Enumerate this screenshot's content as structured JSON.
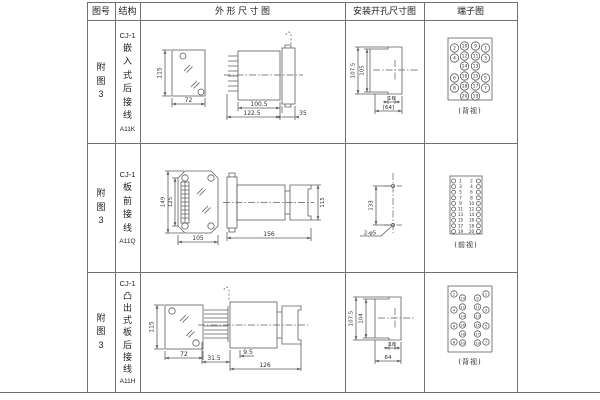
{
  "header": {
    "fig": "图号",
    "structure": "结构",
    "outline": "外 形 尺 寸 图",
    "install": "安装开孔尺寸图",
    "terminal": "端子图"
  },
  "rows": [
    {
      "fig": "附图3",
      "structure": {
        "model": "CJ-1",
        "mount": "嵌入式后接线",
        "code": "A11K"
      },
      "outline": {
        "front_h": "115",
        "front_w": "72",
        "side_d1": "100.5",
        "side_d2": "122.5",
        "side_d3": "35"
      },
      "install": {
        "v_outer": "107.5",
        "v_inner": "105",
        "h_small": "16",
        "h_bracket": "[64]"
      },
      "terminal": {
        "view": "(背视)",
        "grid": [
          [
            "2",
            "10",
            "9",
            "1"
          ],
          [
            "4",
            "12",
            "11",
            "3"
          ],
          [
            "14",
            "13"
          ],
          [
            "6",
            "16",
            "15",
            "5"
          ],
          [
            "8",
            "18",
            "17",
            "7"
          ],
          [
            "20",
            "19"
          ]
        ]
      }
    },
    {
      "fig": "附图3",
      "structure": {
        "model": "CJ-1",
        "mount": "板前接线",
        "code": "A11Q"
      },
      "outline": {
        "front_h1": "149",
        "front_h2": "125",
        "front_w": "105",
        "side_len": "156",
        "side_h": "115"
      },
      "install": {
        "v": "133",
        "holes": "2-φ5"
      },
      "terminal": {
        "view": "(前视)",
        "left": [
          "1",
          "3",
          "5",
          "7",
          "9",
          "11",
          "13",
          "15",
          "17",
          "19"
        ],
        "right": [
          "2",
          "4",
          "6",
          "8",
          "10",
          "12",
          "14",
          "16",
          "18",
          "20"
        ]
      }
    },
    {
      "fig": "附图3",
      "structure": {
        "model": "CJ-1",
        "mount": "凸出式板后接线",
        "code": "A11H"
      },
      "outline": {
        "front_h": "115",
        "front_w": "72",
        "side_d1": "31.5",
        "side_d2": "9.5",
        "side_d3": "126"
      },
      "install": {
        "v_outer": "107.5",
        "v_inner": "104",
        "h_small": "16",
        "h_width": "64"
      },
      "terminal": {
        "view": "(背视)",
        "left_outer": [
          "2",
          "4",
          "6",
          "8"
        ],
        "left_inner": [
          "10",
          "12",
          "14",
          "16",
          "18",
          "20"
        ],
        "right_inner": [
          "9",
          "11",
          "13",
          "15",
          "17",
          "19"
        ],
        "right_outer": [
          "1",
          "3",
          "5",
          "7"
        ]
      }
    }
  ]
}
